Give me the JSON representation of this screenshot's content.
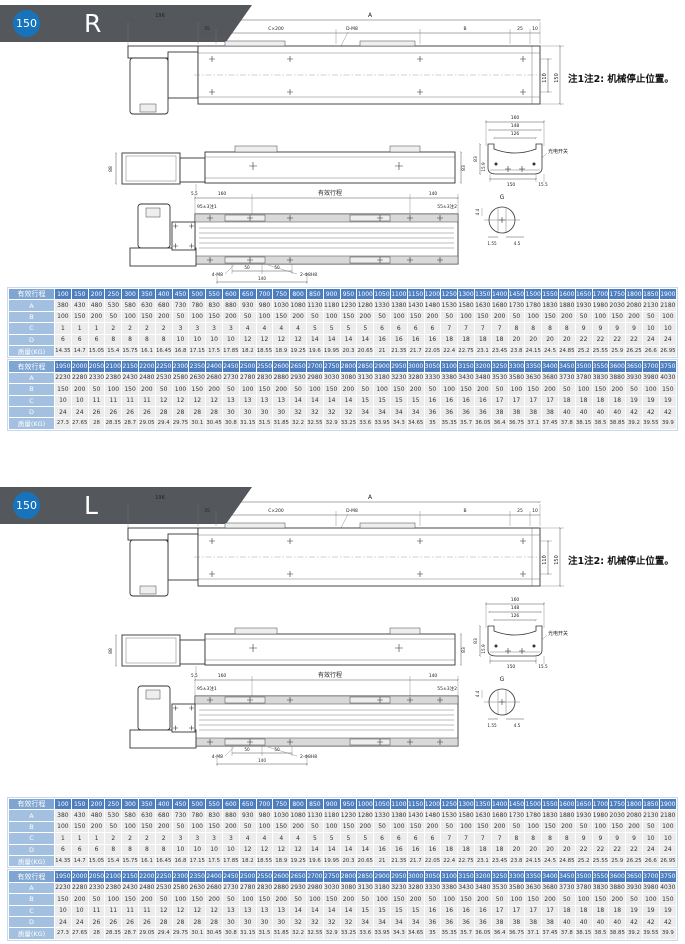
{
  "colors": {
    "badge_bg": "#54585c",
    "badge_circle": "#1774bc",
    "table_header_bg": "#4d7ec0",
    "table_row_label_bg": "#a3c0e0",
    "table_stroke_label_bg": "#7fa5d2"
  },
  "sections": [
    {
      "badge_num": "150",
      "badge_letter": "R"
    },
    {
      "badge_num": "150",
      "badge_letter": "L"
    }
  ],
  "drawing": {
    "note": "注1注2: 机械停止位置。",
    "top_view": {
      "len_196": "196",
      "len_A": "A",
      "len_35": "35",
      "holes_c": "C×200",
      "holes_d": "D-M8",
      "len_B": "B",
      "len_25": "25",
      "len_10": "10",
      "w_110": "110",
      "w_150": "150"
    },
    "side_view": {
      "h_88": "88",
      "h_5_5": "5.5",
      "h_83": "83"
    },
    "plan_view": {
      "len_160": "160",
      "stroke_label": "有效行程",
      "len_140": "140",
      "tol_left": "95±3注1",
      "tol_right": "55±3注2",
      "holes_m8": "4-M8",
      "d50_1": "50",
      "d50_2": "50",
      "holes_pin": "2-Φ8H8",
      "len_140b": "140"
    },
    "cross_section": {
      "w_160": "160",
      "w_148": "148",
      "w_126": "126",
      "h_83": "83",
      "h_15_9": "15.9",
      "w_150": "150",
      "w_15_5": "15.5",
      "switch_label": "光电开关"
    },
    "g_detail": {
      "title": "G",
      "d_4_4": "4.4",
      "d_1_55": "1.55",
      "d_4_5": "4.5"
    }
  },
  "tables": {
    "t1": {
      "header_label": "有效行程",
      "strokes": [
        100,
        150,
        200,
        250,
        300,
        350,
        400,
        450,
        500,
        550,
        600,
        650,
        700,
        750,
        800,
        850,
        900,
        950,
        1000,
        1050,
        1100,
        1150,
        1200,
        1250,
        1300,
        1350,
        1400,
        1450,
        1500,
        1550,
        1600,
        1650,
        1700,
        1750,
        1800,
        1850,
        1900
      ],
      "rows": [
        {
          "key": "A",
          "label": "A",
          "values": [
            380,
            430,
            480,
            530,
            580,
            630,
            680,
            730,
            780,
            830,
            880,
            930,
            980,
            1030,
            1080,
            1130,
            1180,
            1230,
            1280,
            1330,
            1380,
            1430,
            1480,
            1530,
            1580,
            1630,
            1680,
            1730,
            1780,
            1830,
            1880,
            1930,
            1980,
            2030,
            2080,
            2130,
            2180
          ]
        },
        {
          "key": "B",
          "label": "B",
          "values": [
            100,
            150,
            200,
            50,
            100,
            150,
            200,
            50,
            100,
            150,
            200,
            50,
            100,
            150,
            200,
            50,
            100,
            150,
            200,
            50,
            100,
            150,
            200,
            50,
            100,
            150,
            200,
            50,
            100,
            150,
            200,
            50,
            100,
            150,
            200,
            50,
            100
          ]
        },
        {
          "key": "C",
          "label": "C",
          "values": [
            1,
            1,
            1,
            2,
            2,
            2,
            2,
            3,
            3,
            3,
            3,
            4,
            4,
            4,
            4,
            5,
            5,
            5,
            5,
            6,
            6,
            6,
            6,
            7,
            7,
            7,
            7,
            8,
            8,
            8,
            8,
            9,
            9,
            9,
            9,
            10,
            10
          ]
        },
        {
          "key": "D",
          "label": "D",
          "values": [
            6,
            6,
            6,
            8,
            8,
            8,
            8,
            10,
            10,
            10,
            10,
            12,
            12,
            12,
            12,
            14,
            14,
            14,
            14,
            16,
            16,
            16,
            16,
            18,
            18,
            18,
            18,
            20,
            20,
            20,
            20,
            22,
            22,
            22,
            22,
            24,
            24
          ]
        },
        {
          "key": "mass",
          "label": "质量(KG)",
          "values": [
            14.35,
            14.7,
            15.05,
            15.4,
            15.75,
            16.1,
            16.45,
            16.8,
            17.15,
            17.5,
            17.85,
            18.2,
            18.55,
            18.9,
            19.25,
            19.6,
            19.95,
            20.3,
            20.65,
            21,
            21.35,
            21.7,
            22.05,
            22.4,
            22.75,
            23.1,
            23.45,
            23.8,
            24.15,
            24.5,
            24.85,
            25.2,
            25.55,
            25.9,
            26.25,
            26.6,
            26.95
          ]
        }
      ]
    },
    "t2": {
      "header_label": "有效行程",
      "strokes": [
        1950,
        2000,
        2050,
        2100,
        2150,
        2200,
        2250,
        2300,
        2350,
        2400,
        2450,
        2500,
        2550,
        2600,
        2650,
        2700,
        2750,
        2800,
        2850,
        2900,
        2950,
        3000,
        3050,
        3100,
        3150,
        3200,
        3250,
        3300,
        3350,
        3400,
        3450,
        3500,
        3550,
        3600,
        3650,
        3700,
        3750
      ],
      "rows": [
        {
          "key": "A",
          "label": "A",
          "values": [
            2230,
            2280,
            2330,
            2380,
            2430,
            2480,
            2530,
            2580,
            2630,
            2680,
            2730,
            2780,
            2830,
            2880,
            2930,
            2980,
            3030,
            3080,
            3130,
            3180,
            3230,
            3280,
            3330,
            3380,
            3430,
            3480,
            3530,
            3580,
            3630,
            3680,
            3730,
            3780,
            3830,
            3880,
            3930,
            3980,
            4030
          ]
        },
        {
          "key": "B",
          "label": "B",
          "values": [
            150,
            200,
            50,
            100,
            150,
            200,
            50,
            100,
            150,
            200,
            50,
            100,
            150,
            200,
            50,
            100,
            150,
            200,
            50,
            100,
            150,
            200,
            50,
            100,
            150,
            200,
            50,
            100,
            150,
            200,
            50,
            100,
            150,
            200,
            50,
            100,
            150
          ]
        },
        {
          "key": "C",
          "label": "C",
          "values": [
            10,
            10,
            11,
            11,
            11,
            11,
            12,
            12,
            12,
            12,
            13,
            13,
            13,
            13,
            14,
            14,
            14,
            14,
            15,
            15,
            15,
            15,
            16,
            16,
            16,
            16,
            17,
            17,
            17,
            17,
            18,
            18,
            18,
            18,
            19,
            19,
            19
          ]
        },
        {
          "key": "D",
          "label": "D",
          "values": [
            24,
            24,
            26,
            26,
            26,
            26,
            28,
            28,
            28,
            28,
            30,
            30,
            30,
            30,
            32,
            32,
            32,
            32,
            34,
            34,
            34,
            34,
            36,
            36,
            36,
            36,
            38,
            38,
            38,
            38,
            40,
            40,
            40,
            40,
            42,
            42,
            42
          ]
        },
        {
          "key": "mass",
          "label": "质量(KG)",
          "values": [
            27.3,
            27.65,
            28,
            28.35,
            28.7,
            29.05,
            29.4,
            29.75,
            30.1,
            30.45,
            30.8,
            31.15,
            31.5,
            31.85,
            32.2,
            32.55,
            32.9,
            33.25,
            33.6,
            33.95,
            34.3,
            34.65,
            35,
            35.35,
            35.7,
            36.05,
            36.4,
            36.75,
            37.1,
            37.45,
            37.8,
            38.15,
            38.5,
            38.85,
            39.2,
            39.55,
            39.9
          ]
        }
      ]
    }
  }
}
